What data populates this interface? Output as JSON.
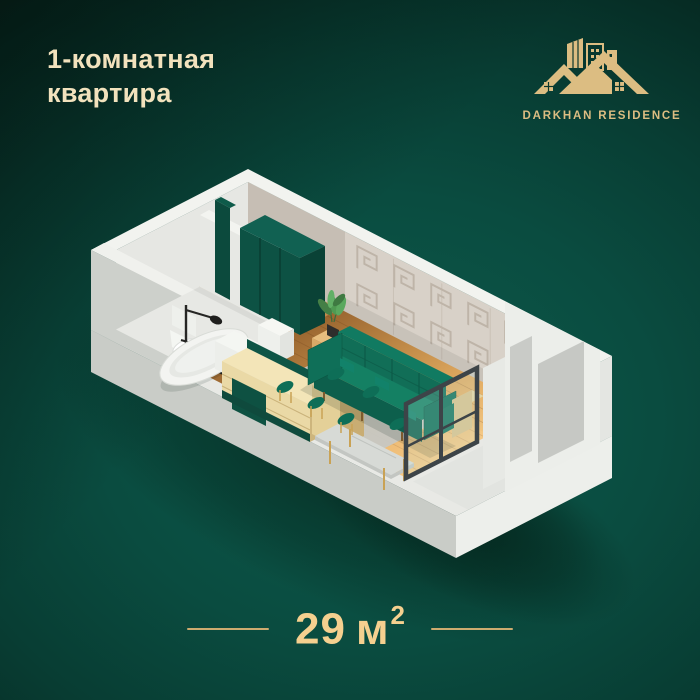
{
  "meta": {
    "kind": "real-estate apartment floorplan poster"
  },
  "title": {
    "line1": "1-комнатная",
    "line2": "квартира"
  },
  "logo": {
    "text": "DARKHAN RESIDENCE"
  },
  "area": {
    "value": "29",
    "unit": "м",
    "sup": "2"
  },
  "palette": {
    "background_center": "#0d5b4c",
    "background_edge": "#08211a",
    "title_text": "#f2e2bd",
    "logo_gold": "#dcbd82",
    "area_text": "#f5d08f",
    "divider_gold": "#cdab6f",
    "wall_light": "#e8e9e5",
    "wall_pattern": "#d8d1c8",
    "wood_floor": "#d49a55",
    "accent_teal": "#0f6b55",
    "cabinet_gold": "#ead9a6"
  },
  "floorplan": {
    "label": "isometric 3d cutaway of studio apartment",
    "rooms": [
      "hallway",
      "bathroom",
      "kitchen",
      "living-dining",
      "balcony"
    ],
    "furniture": [
      "bathtub",
      "shower",
      "toilet",
      "wardrobe",
      "kitchen-cabinet",
      "counter",
      "sideboard",
      "plant",
      "sofa",
      "dining-table",
      "chairs",
      "glass-partition",
      "balcony-cabinet"
    ]
  }
}
